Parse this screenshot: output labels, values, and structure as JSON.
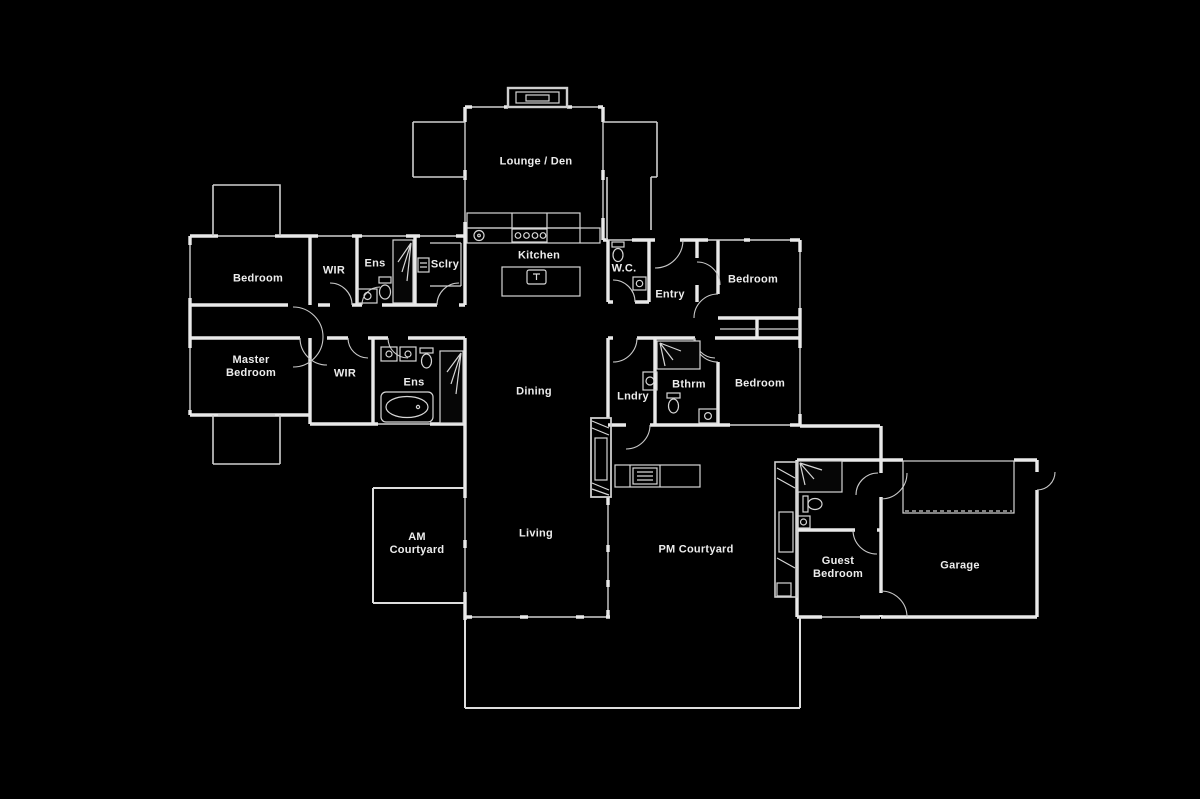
{
  "canvas": {
    "width": 1200,
    "height": 799,
    "background": "#000000",
    "wall_color": "#e9e9e9",
    "thin_line_color": "#cfcfcf",
    "label_color": "#ededed"
  },
  "rooms": [
    {
      "id": "lounge-den",
      "label": "Lounge / Den",
      "x": 536,
      "y": 162
    },
    {
      "id": "kitchen",
      "label": "Kitchen",
      "x": 539,
      "y": 256
    },
    {
      "id": "bedroom-1",
      "label": "Bedroom",
      "x": 258,
      "y": 279
    },
    {
      "id": "wir-1",
      "label": "WIR",
      "x": 334,
      "y": 271
    },
    {
      "id": "ens-1",
      "label": "Ens",
      "x": 375,
      "y": 264
    },
    {
      "id": "sclry",
      "label": "Sclry",
      "x": 445,
      "y": 265
    },
    {
      "id": "wc",
      "label": "W.C.",
      "x": 624,
      "y": 269
    },
    {
      "id": "entry",
      "label": "Entry",
      "x": 670,
      "y": 295
    },
    {
      "id": "bedroom-2",
      "label": "Bedroom",
      "x": 753,
      "y": 280
    },
    {
      "id": "master-bedroom",
      "label": "Master\nBedroom",
      "x": 251,
      "y": 367
    },
    {
      "id": "wir-2",
      "label": "WIR",
      "x": 345,
      "y": 374
    },
    {
      "id": "ens-2",
      "label": "Ens",
      "x": 414,
      "y": 383
    },
    {
      "id": "dining",
      "label": "Dining",
      "x": 534,
      "y": 392
    },
    {
      "id": "lndry",
      "label": "Lndry",
      "x": 633,
      "y": 397
    },
    {
      "id": "bthrm",
      "label": "Bthrm",
      "x": 689,
      "y": 385
    },
    {
      "id": "bedroom-3",
      "label": "Bedroom",
      "x": 760,
      "y": 384
    },
    {
      "id": "living",
      "label": "Living",
      "x": 536,
      "y": 534
    },
    {
      "id": "am-courtyard",
      "label": "AM\nCourtyard",
      "x": 417,
      "y": 544
    },
    {
      "id": "pm-courtyard",
      "label": "PM Courtyard",
      "x": 696,
      "y": 550
    },
    {
      "id": "guest-bedroom",
      "label": "Guest\nBedroom",
      "x": 838,
      "y": 568
    },
    {
      "id": "garage",
      "label": "Garage",
      "x": 960,
      "y": 566
    }
  ],
  "fixture_icons": [
    "fireplace-icon",
    "kitchen-sink-icon",
    "stove-icon",
    "island-sink-icon",
    "scullery-appliance-icon",
    "shower-icon",
    "toilet-icon",
    "vanity-basin-icon",
    "bathtub-icon",
    "washing-machine-icon",
    "bbq-icon",
    "outdoor-fireplace-icon",
    "garage-door-dashed-line"
  ]
}
